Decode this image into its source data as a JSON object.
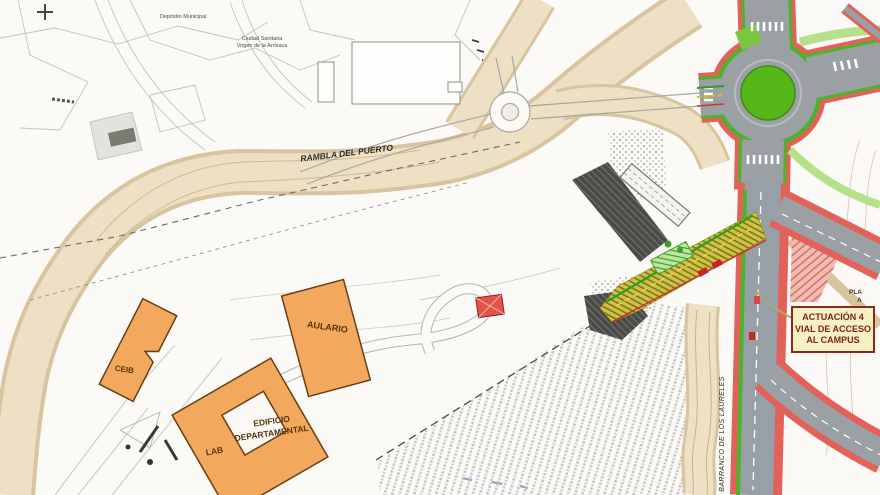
{
  "annotation_box": {
    "line1": "ACTUACIÓN 4",
    "line2": "VIAL DE ACCESO",
    "line3": "AL CAMPUS"
  },
  "labels": {
    "rambla": "RAMBLA DEL PUERTO",
    "barranco": "BARRANCO DE LOS LAURELES",
    "deposito": "Depósito Municipal",
    "ciudad_sanitaria_line1": "Ciudad Sanitaria",
    "ciudad_sanitaria_line2": "Virgen de la Arrixaca",
    "edge_partial_line1": "PLA",
    "edge_partial_line2": "A"
  },
  "buildings": {
    "aulario": "AULARIO",
    "ceib": "CEIB",
    "lab": "LAB",
    "departamental_line1": "EDIFICIO",
    "departamental_line2": "DEPARTAMENTAL"
  },
  "colors": {
    "building_fill": "#f2a95e",
    "building_border": "#6b3d12",
    "roundabout_center_green": "#55b818",
    "road_gray": "#97a0a6",
    "sidewalk_red": "#e2625a",
    "curb_green": "#4db32a",
    "rambla_tan": "#eee0c4",
    "construction_olive": "#cfc24a",
    "field_gray": "#c6c6c3",
    "annotation_bg": "#f6f0c2",
    "annotation_border": "#8a2a22",
    "annotation_text": "#7a241c"
  }
}
